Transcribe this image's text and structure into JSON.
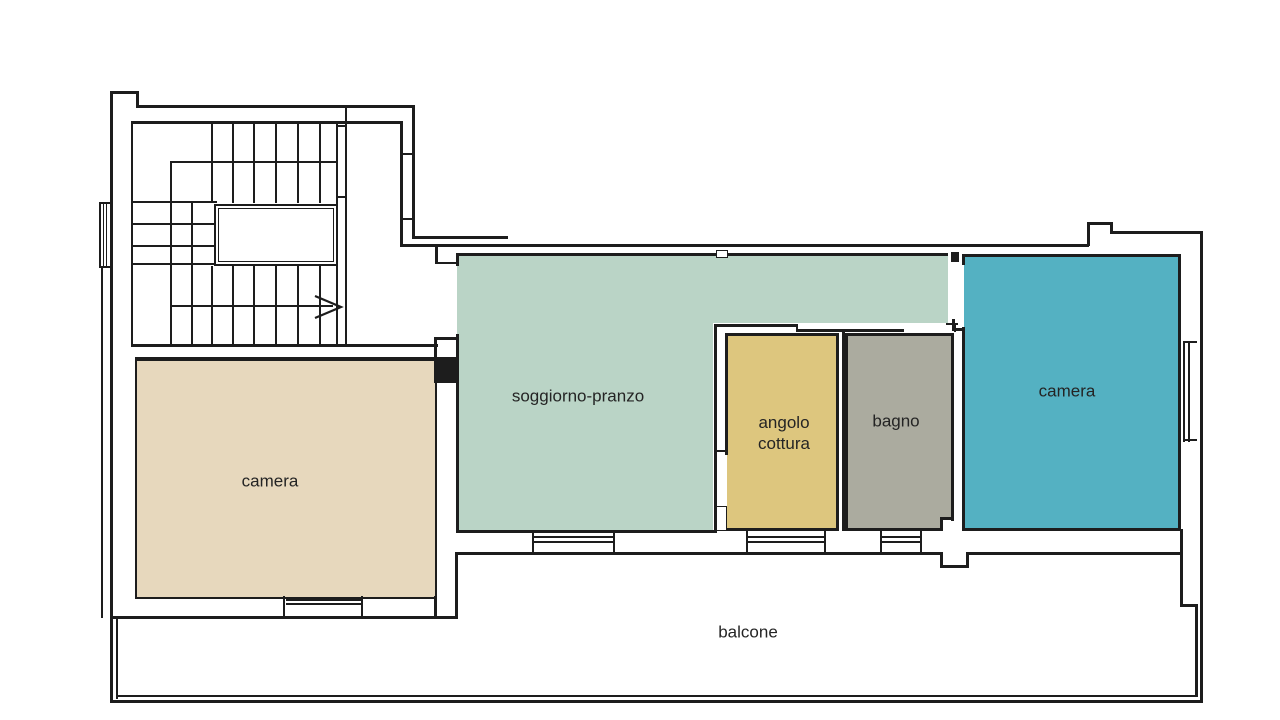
{
  "plan_title": "apartment floor plan",
  "wall_color": "#1d1d1d",
  "background_color": "#ffffff",
  "rooms": {
    "camera_left": {
      "label": "camera",
      "color": "#e7d8bd"
    },
    "soggiorno_pranzo": {
      "label": "soggiorno-pranzo",
      "color": "#bad4c6"
    },
    "angolo_cottura": {
      "label": "angolo cottura",
      "color": "#ddc67e"
    },
    "bagno": {
      "label": "bagno",
      "color": "#abab9f"
    },
    "camera_right": {
      "label": "camera",
      "color": "#54b1c2"
    },
    "balcone": {
      "label": "balcone",
      "color": "#ffffff"
    }
  },
  "stair_direction": "right"
}
